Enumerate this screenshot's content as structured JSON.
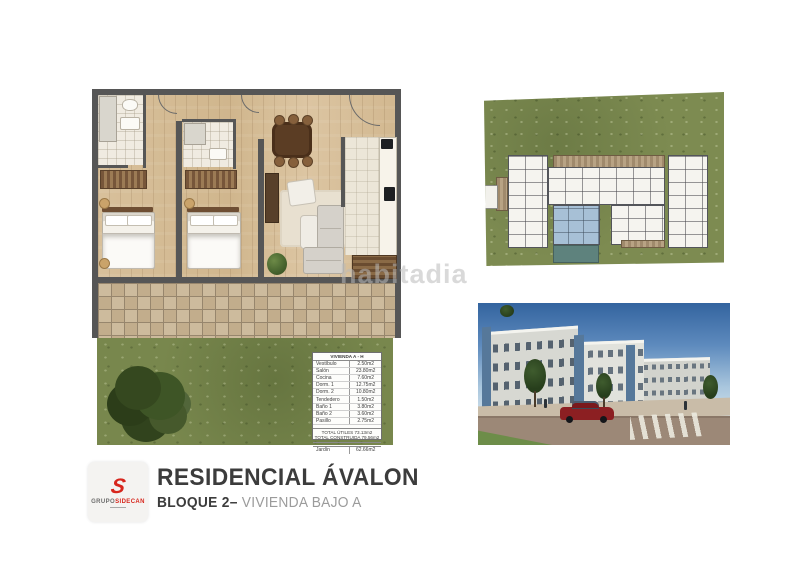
{
  "colors": {
    "logo_red": "#d7261d",
    "title_text": "#3c3c3c",
    "subtitle_muted": "#9b9b9b",
    "plan_wall_gray": "#565656",
    "wood_floor": "#d6bd97",
    "terrace_tile": "#c8b494",
    "grass_green": "#78874d",
    "unit_highlight_blue": "#a7c0d6",
    "pool_teal": "#5e827d",
    "sky_blue": "#33649f"
  },
  "watermark": {
    "text": "habitadia"
  },
  "floorplan_table": {
    "header": "VIVIENDA A - H",
    "rows": [
      {
        "label": "Vestíbulo",
        "value": "2.50m2"
      },
      {
        "label": "Salón",
        "value": "23.80m2"
      },
      {
        "label": "Cocina",
        "value": "7.60m2"
      },
      {
        "label": "Dorm. 1",
        "value": "12.75m2"
      },
      {
        "label": "Dorm. 2",
        "value": "10.80m2"
      },
      {
        "label": "Tendedero",
        "value": "1.50m2"
      },
      {
        "label": "Baño 1",
        "value": "3.80m2"
      },
      {
        "label": "Baño 2",
        "value": "3.60m2"
      },
      {
        "label": "Pasillo",
        "value": "2.75m2"
      }
    ],
    "total_utiles": "TOTAL ÚTILES 73.13m2",
    "total_construida": "TOTAL CONSTRUIDA 79.56m2",
    "jardin_label": "Jardín",
    "jardin_value": "62.66m2"
  },
  "footer": {
    "title": "RESIDENCIAL ÁVALON",
    "subtitle_block": "BLOQUE 2–",
    "subtitle_unit": " VIVIENDA BAJO A",
    "logo": {
      "monogram": "S",
      "brand_gray": "GRUPO",
      "brand_red": "SIDECAN"
    }
  }
}
